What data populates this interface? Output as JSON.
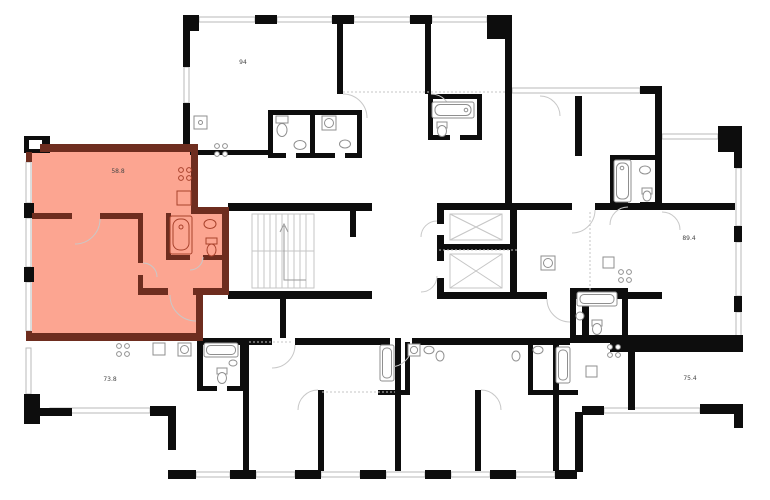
{
  "plan": {
    "kind": "residential-floor-plan",
    "selected_unit": {
      "area": "58.8",
      "highlighted": true
    },
    "units": [
      {
        "id": "unit-94",
        "area": "94",
        "highlighted": false
      },
      {
        "id": "unit-58-8",
        "area": "58.8",
        "highlighted": true
      },
      {
        "id": "unit-89-4",
        "area": "89.4",
        "highlighted": false
      },
      {
        "id": "unit-73-8",
        "area": "73.8",
        "highlighted": false
      },
      {
        "id": "unit-75-4",
        "area": "75.4",
        "highlighted": false
      }
    ],
    "core": {
      "stairwell": true,
      "elevator_count": 2
    },
    "fixture_icons": [
      "stove-icon",
      "bathtub-icon",
      "sink-icon",
      "toilet-icon",
      "washer-icon"
    ],
    "colors": {
      "highlight_fill": "#FCA591",
      "highlight_wall": "#6E2D1F",
      "wall": "#0D0D0D",
      "window": "#B9B9B9",
      "background": "#FFFFFF"
    }
  }
}
